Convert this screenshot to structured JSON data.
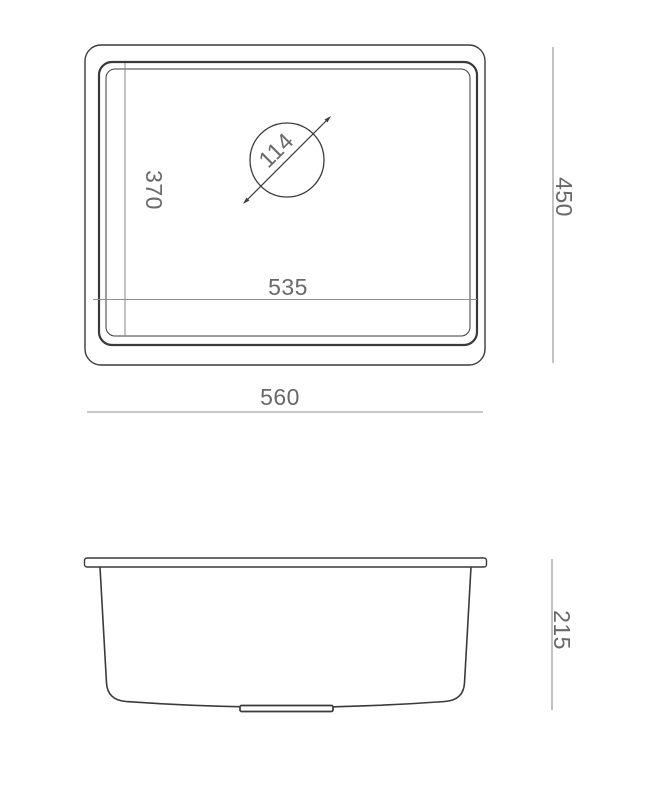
{
  "drawing": {
    "kind": "sink-dimension-technical-drawing",
    "colors": {
      "outline": "#3a3a3a",
      "dim_line": "#909090",
      "dim_text": "#696969",
      "background": "#ffffff"
    },
    "top_view": {
      "labels": {
        "bowl_depth": "370",
        "drain_diameter": "114",
        "bowl_width": "535",
        "overall_width": "560",
        "overall_depth": "450"
      }
    },
    "side_view": {
      "labels": {
        "height": "215"
      }
    }
  }
}
